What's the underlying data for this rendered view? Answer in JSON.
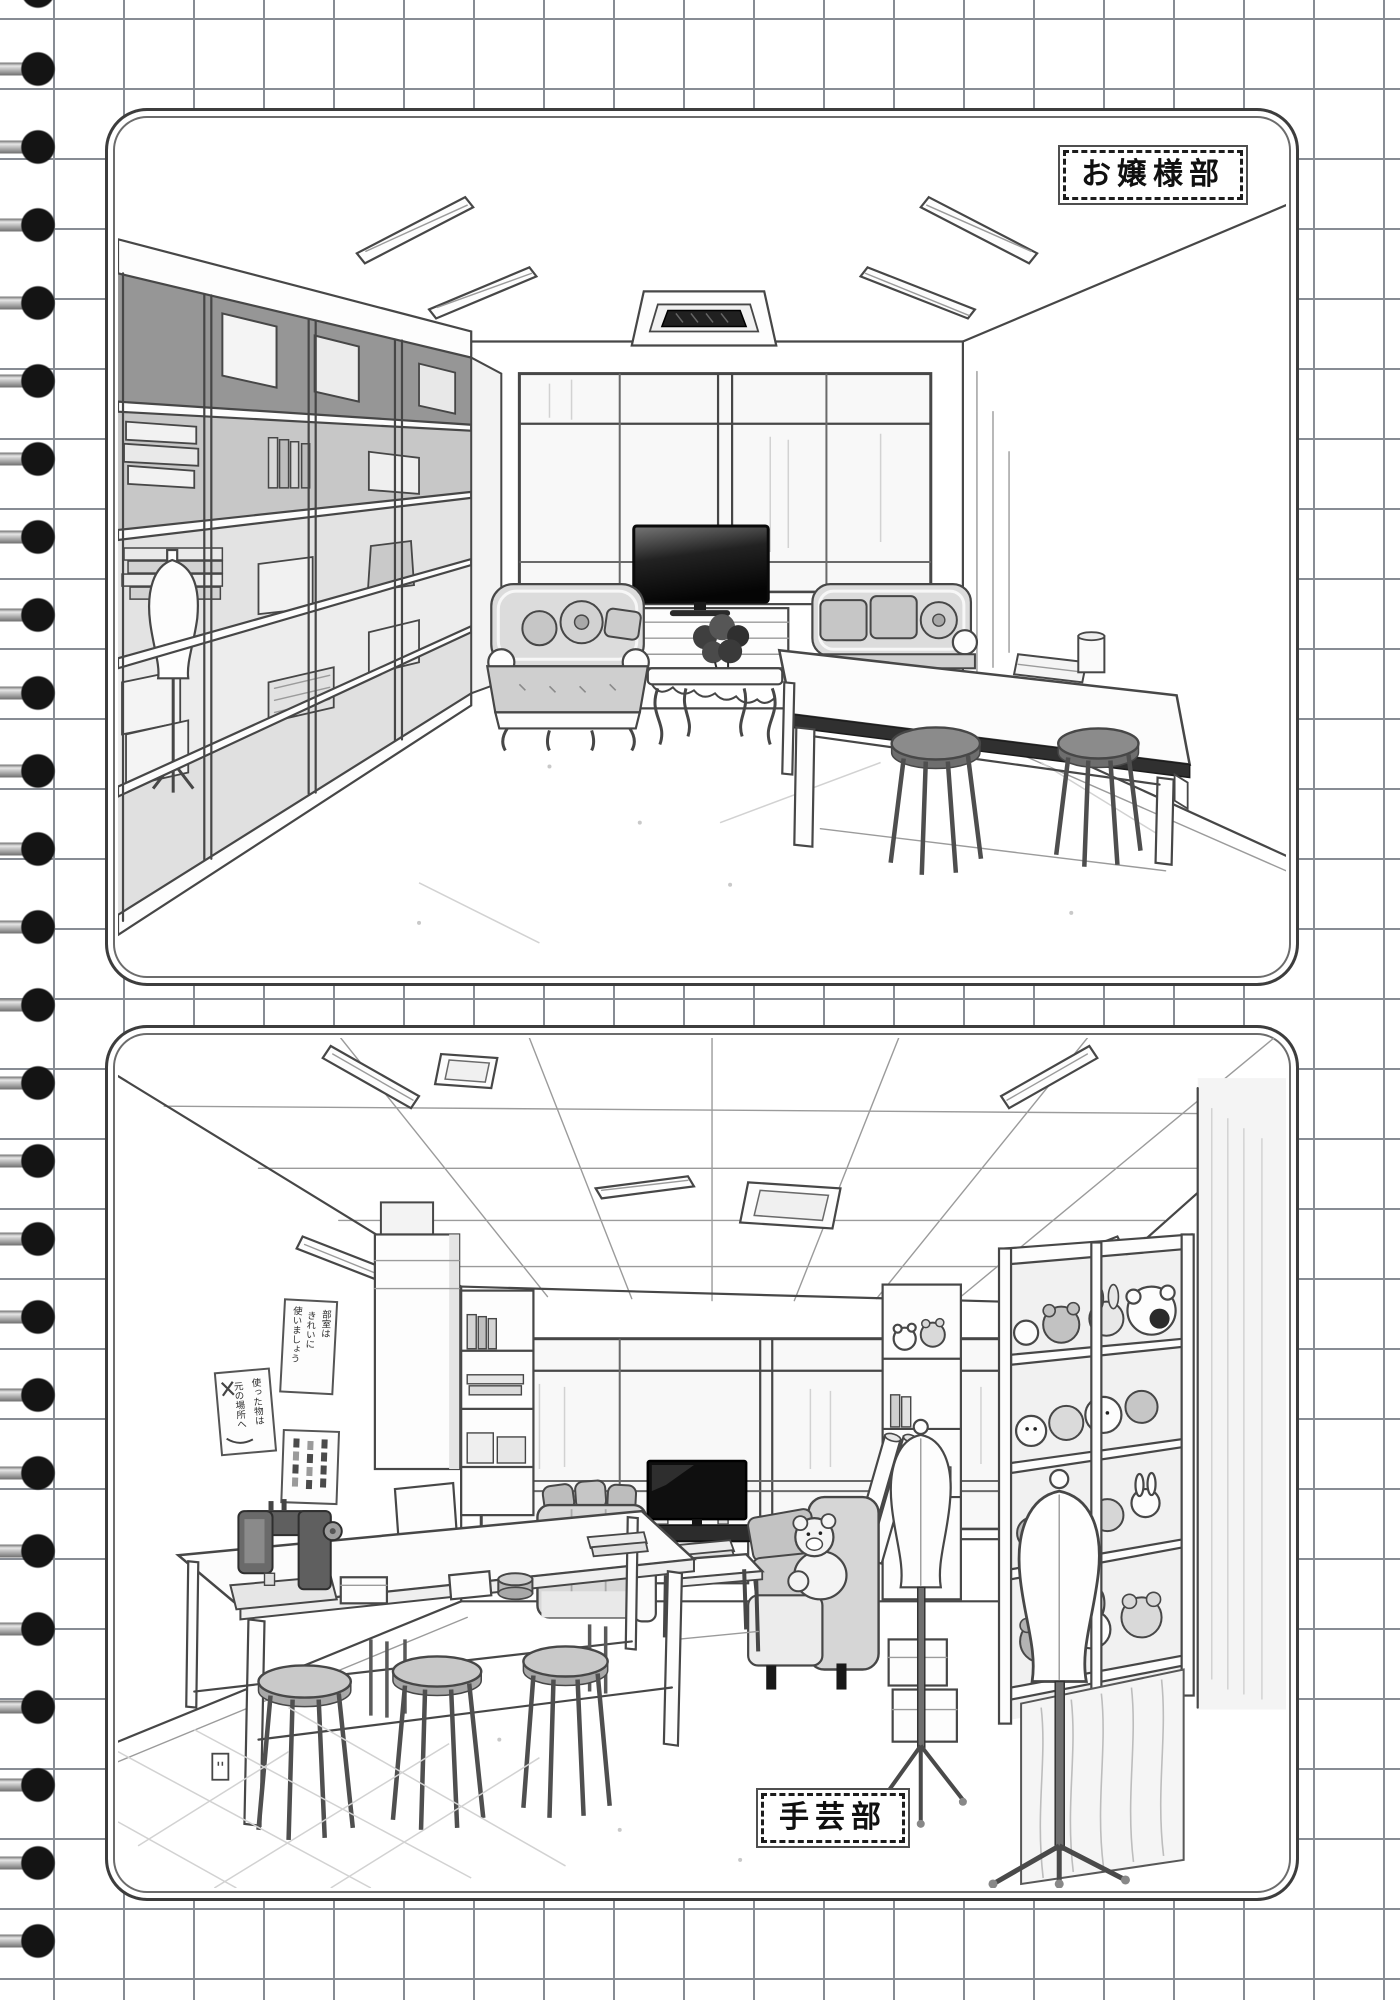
{
  "colors": {
    "paper": "#ffffff",
    "grid_line": "#878c94",
    "panel_border": "#3d3d3d",
    "panel_inner_border": "#6c6c6c",
    "binding_ring": "#141414",
    "binding_wire": "#9c9c9c",
    "ink_line": "#474747",
    "tv_screen": "#121212",
    "upholstery_gray": "#cfcfcf"
  },
  "notebook": {
    "binding_ring_count": 25,
    "grid_cell_px": 70
  },
  "panels": [
    {
      "name": "ojousama-club-room",
      "label": "お嬢様部",
      "label_position": "top-right",
      "objects": [
        "ceiling-lights",
        "air-conditioner",
        "wall-shelf-unit",
        "stacked-books",
        "storage-boxes",
        "fabric-stacks",
        "dress-form",
        "windows",
        "television",
        "tv-cabinet",
        "ornate-sofa-left",
        "ornate-sofa-right",
        "flower-arrangement",
        "ornate-coffee-table",
        "work-table",
        "book-on-table",
        "cup-on-table",
        "stools",
        "wall-outlet"
      ]
    },
    {
      "name": "handicrafts-club-room",
      "label": "手芸部",
      "label_position": "bottom-center",
      "posters": [
        {
          "lines": [
            "部室は",
            "きれいに",
            "使いましょう"
          ]
        },
        {
          "lines": [
            "使った物は",
            "元の場所へ"
          ]
        },
        {
          "lines": []
        }
      ],
      "objects": [
        "ceiling-tile-grid",
        "ceiling-lights",
        "ceiling-vent",
        "windows",
        "television",
        "tv-cabinet",
        "mug",
        "sofa-left",
        "sofa-right",
        "teddy-bear",
        "coffee-table",
        "books",
        "sewing-machine",
        "accessory-boxes",
        "round-tins",
        "work-table",
        "stools",
        "tall-cabinet",
        "cubby-shelf",
        "leaning-board",
        "posters",
        "plush-toy-shelves",
        "plush-toys",
        "storage-boxes",
        "hanging-fabric",
        "fabric-rolls",
        "dress-forms",
        "wall-outlet",
        "floor-tiles"
      ]
    }
  ]
}
